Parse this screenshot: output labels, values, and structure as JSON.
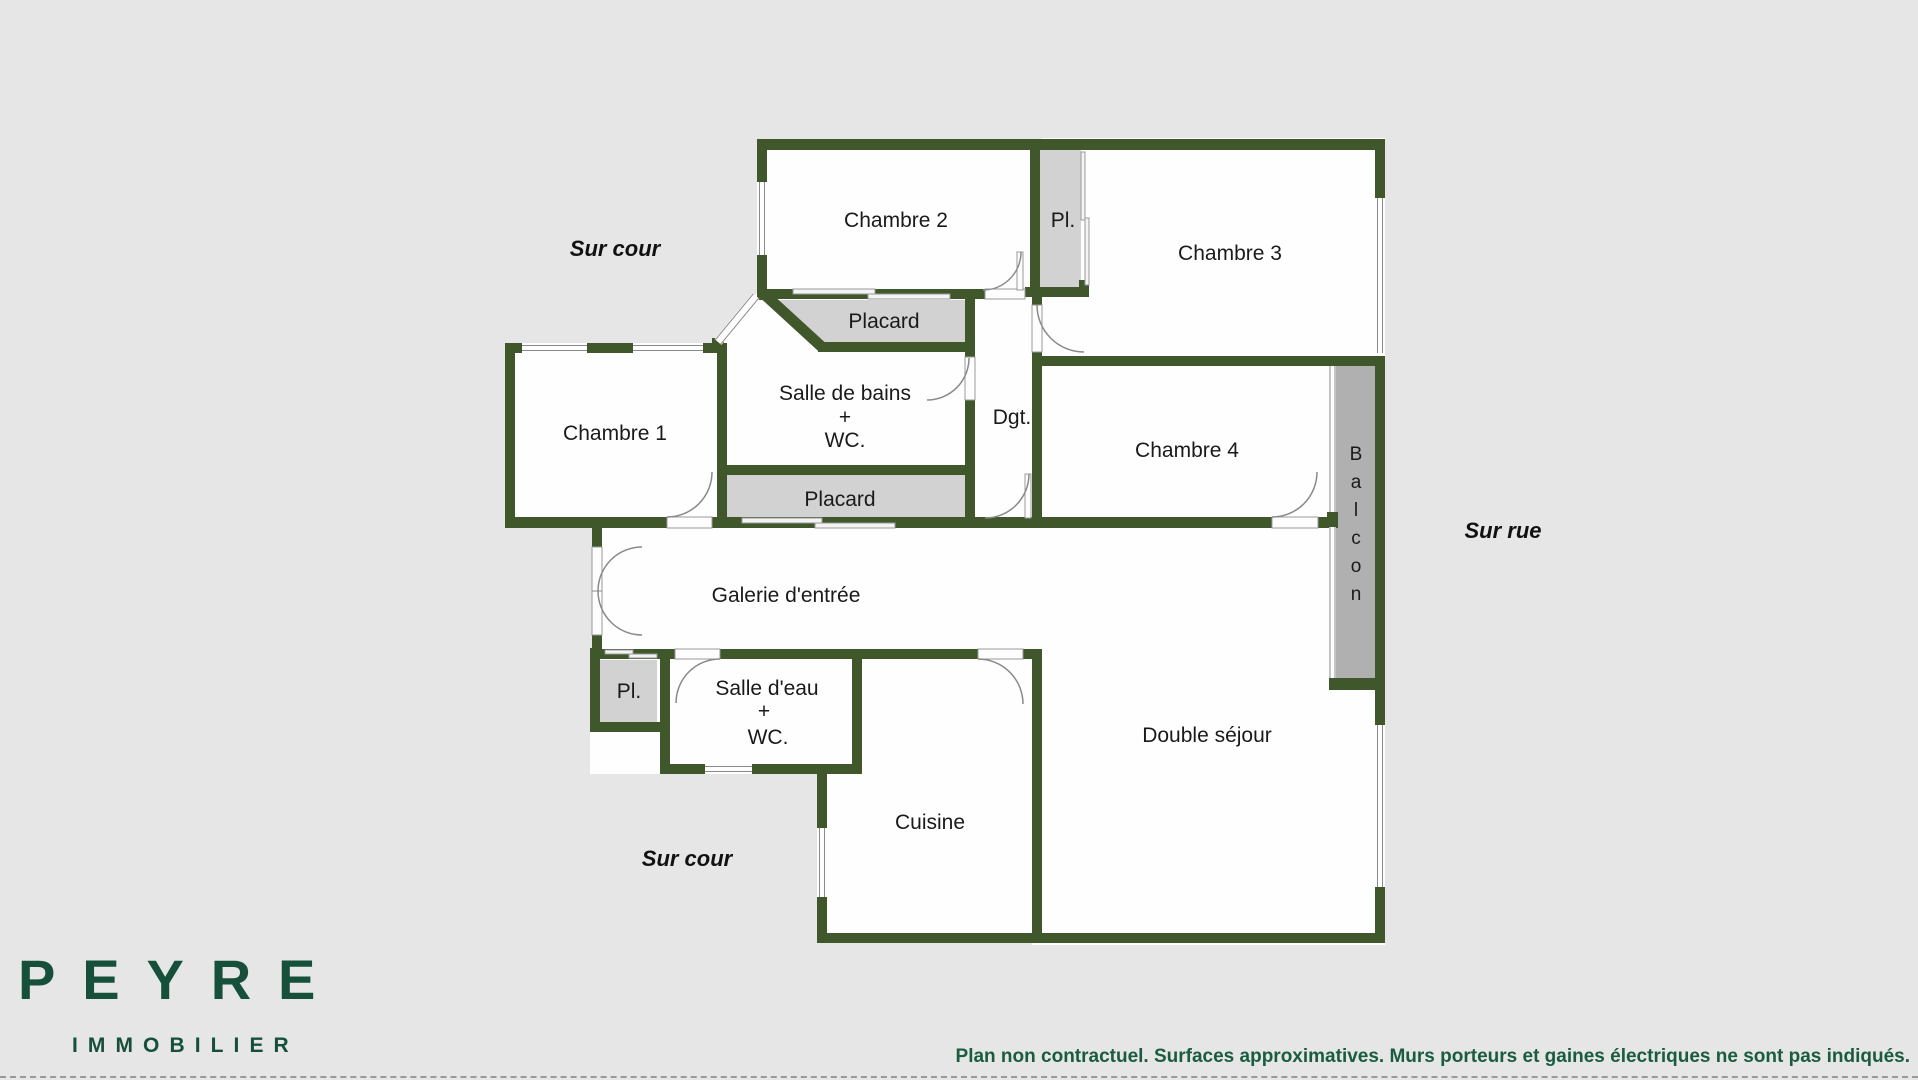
{
  "colors": {
    "background": "#e6e6e6",
    "wall_green": "#40572c",
    "room_fill": "#fefefe",
    "closet_gray": "#d2d2d2",
    "balcony_gray": "#b0b0b0",
    "brand_green": "#17503a",
    "disclaimer_green": "#1a5c40"
  },
  "plan": {
    "rooms": {
      "chambre1": "Chambre 1",
      "chambre2": "Chambre 2",
      "chambre3": "Chambre 3",
      "chambre4": "Chambre 4",
      "pl_top": "Pl.",
      "placard_top": "Placard",
      "sdb_l1": "Salle de bains",
      "sdb_l2": "+",
      "sdb_l3": "WC.",
      "placard_bottom": "Placard",
      "dgt": "Dgt.",
      "galerie": "Galerie d'entrée",
      "pl_entry": "Pl.",
      "sde_l1": "Salle d'eau",
      "sde_l2": "+",
      "sde_l3": "WC.",
      "cuisine": "Cuisine",
      "sejour": "Double séjour",
      "balcon_letters": [
        "B",
        "a",
        "l",
        "c",
        "o",
        "n"
      ]
    },
    "annotations": {
      "top": "Sur cour",
      "right": "Sur rue",
      "bottom": "Sur cour"
    }
  },
  "branding": {
    "name": "PEYRE",
    "tagline": "IMMOBILIER"
  },
  "footer": {
    "disclaimer": "Plan non contractuel. Surfaces approximatives. Murs porteurs et gaines électriques ne sont pas indiqués."
  }
}
